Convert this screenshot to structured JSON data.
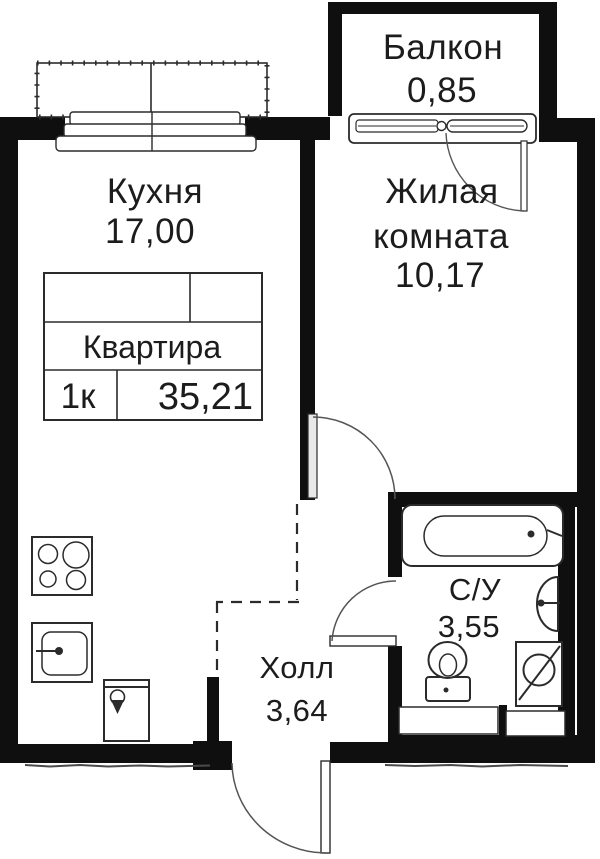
{
  "plan": {
    "type_label": "floor-plan",
    "rooms": {
      "balcony": {
        "name": "Балкон",
        "area": "0,85"
      },
      "kitchen": {
        "name": "Кухня",
        "area": "17,00"
      },
      "living": {
        "name_line1": "Жилая",
        "name_line2": "комната",
        "area": "10,17"
      },
      "bathroom": {
        "name": "С/У",
        "area": "3,55"
      },
      "hall": {
        "name": "Холл",
        "area": "3,64"
      }
    },
    "stamp": {
      "title": "Квартира",
      "rooms_count": "1к",
      "total_area": "35,21"
    },
    "colors": {
      "wall": "#0f0f0f",
      "line": "#2b2b2b",
      "background": "#ffffff"
    }
  }
}
